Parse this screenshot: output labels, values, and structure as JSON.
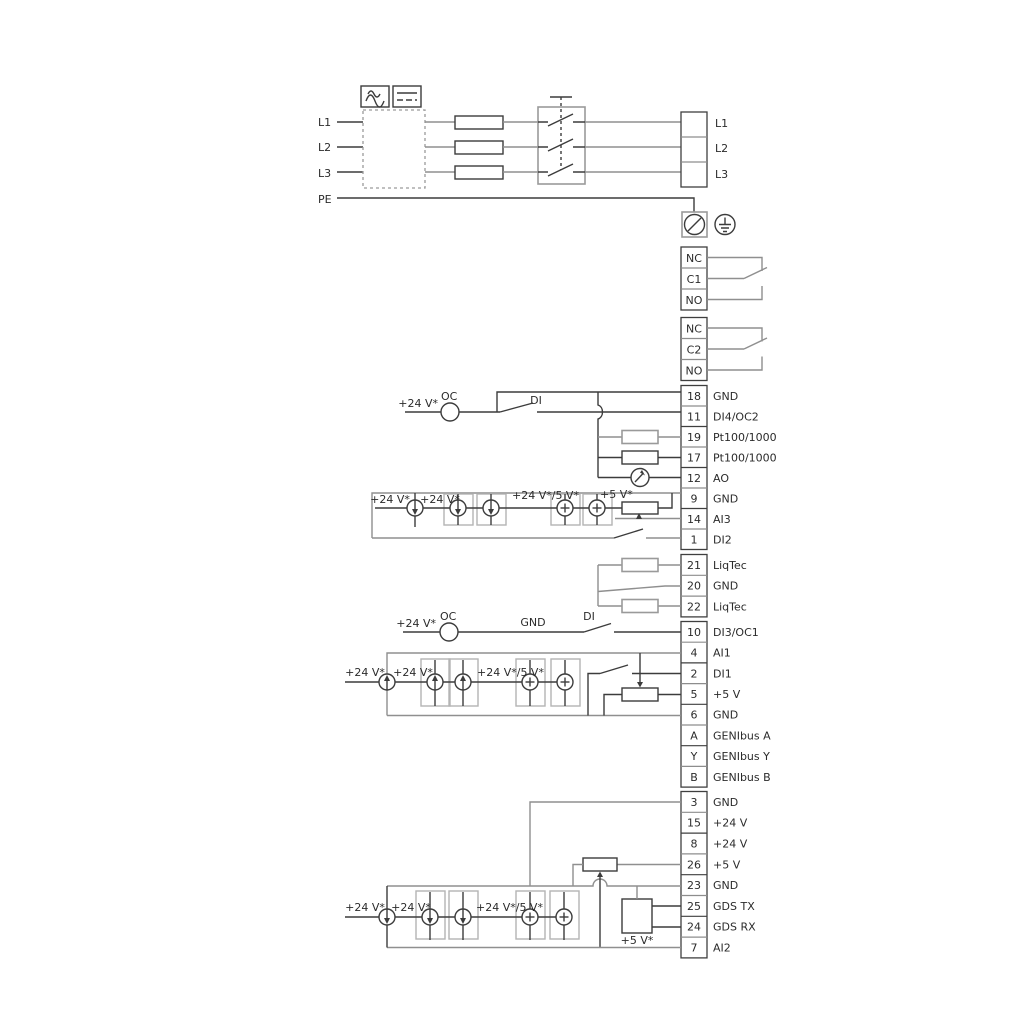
{
  "colors": {
    "wire_gray": "#8f8f8f",
    "wire_dark": "#3c3c3c",
    "text": "#2b2b2b",
    "background": "#ffffff"
  },
  "power": {
    "in": [
      "L1",
      "L2",
      "L3",
      "PE"
    ],
    "out": [
      "L1",
      "L2",
      "L3"
    ]
  },
  "relays": [
    {
      "cells": [
        "NC",
        "C1",
        "NO"
      ]
    },
    {
      "cells": [
        "NC",
        "C2",
        "NO"
      ]
    }
  ],
  "terminals": {
    "io1": [
      {
        "num": "18",
        "label": "GND"
      },
      {
        "num": "11",
        "label": "DI4/OC2"
      },
      {
        "num": "19",
        "label": "Pt100/1000"
      },
      {
        "num": "17",
        "label": "Pt100/1000"
      },
      {
        "num": "12",
        "label": "AO"
      },
      {
        "num": "9",
        "label": "GND"
      },
      {
        "num": "14",
        "label": "AI3"
      },
      {
        "num": "1",
        "label": "DI2"
      }
    ],
    "liqtec": [
      {
        "num": "21",
        "label": "LiqTec"
      },
      {
        "num": "20",
        "label": "GND"
      },
      {
        "num": "22",
        "label": "LiqTec"
      }
    ],
    "io2": [
      {
        "num": "10",
        "label": "DI3/OC1"
      },
      {
        "num": "4",
        "label": "AI1"
      },
      {
        "num": "2",
        "label": "DI1"
      },
      {
        "num": "5",
        "label": "+5 V"
      },
      {
        "num": "6",
        "label": "GND"
      },
      {
        "num": "A",
        "label": "GENIbus A"
      },
      {
        "num": "Y",
        "label": "GENIbus Y"
      },
      {
        "num": "B",
        "label": "GENIbus B"
      }
    ],
    "io3": [
      {
        "num": "3",
        "label": "GND"
      },
      {
        "num": "15",
        "label": "+24 V"
      },
      {
        "num": "8",
        "label": "+24 V"
      },
      {
        "num": "26",
        "label": "+5 V"
      },
      {
        "num": "23",
        "label": "GND"
      },
      {
        "num": "25",
        "label": "GDS TX"
      },
      {
        "num": "24",
        "label": "GDS RX"
      },
      {
        "num": "7",
        "label": "AI2"
      }
    ]
  },
  "ann": {
    "di4": {
      "v24": "+24 V*",
      "oc": "OC",
      "di": "DI"
    },
    "ai3": {
      "v24a": "+24 V*",
      "v24b": "+24 V*",
      "v24_5": "+24 V*/5 V*",
      "v5": "+5 V*"
    },
    "di3": {
      "v24": "+24 V*",
      "oc": "OC",
      "gnd": "GND",
      "di": "DI"
    },
    "ai1": {
      "v24a": "+24 V*",
      "v24b": "+24 V*",
      "v24_5": "+24 V*/5 V*"
    },
    "ai2": {
      "v24a": "+24 V*",
      "v24b": "+24 V*",
      "v24_5": "+24 V*/5 V*",
      "v5": "+5 V*"
    }
  }
}
